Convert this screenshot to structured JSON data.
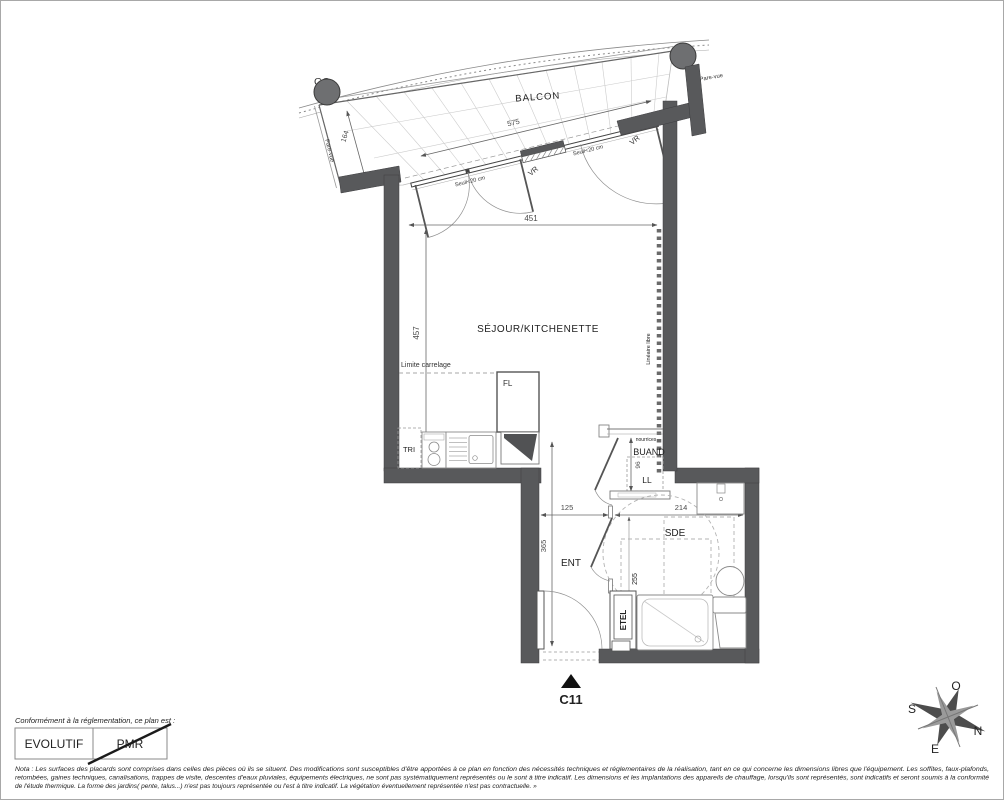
{
  "colors": {
    "wall": "#58595b",
    "accent_dark": "#111111",
    "line_light": "#bbbbbb",
    "background": "#ffffff"
  },
  "plan": {
    "unit_label": "C11",
    "rooms": {
      "balcony": "BALCON",
      "living": "SÉJOUR/KITCHENETTE",
      "laundry": "BUAND",
      "shower_room": "SDE",
      "entrance": "ENT"
    },
    "annotations": {
      "gc": "GC",
      "pare_vue_left": "Pare-vue",
      "pare_vue_right": "Pare-vue",
      "vr_left": "VR",
      "vr_right": "VR",
      "seuil_left": "Seuil<20 cm",
      "seuil_right": "Seuil<20 cm",
      "limite_carrelage": "Limite carrelage",
      "lineaire_libre": "Linéaire libre",
      "tri": "TRI",
      "fl": "FL",
      "ll": "LL",
      "nourrices": "nourrices",
      "etel": "ETEL"
    },
    "dimensions": {
      "balcony_width": "575",
      "balcony_depth": "164",
      "living_width": "451",
      "living_depth": "457",
      "entrance_width": "125",
      "shower_width": "214",
      "entrance_depth": "365",
      "shower_depth": "255",
      "laundry_depth": "96"
    }
  },
  "compass": {
    "north": "N",
    "south": "S",
    "east": "E",
    "west": "O"
  },
  "stamp": {
    "caption": "Conformément à la réglementation, ce plan est :",
    "evolutif": "EVOLUTIF",
    "pmr": "PMR"
  },
  "legal": {
    "line1": "Nota : Les surfaces des placards sont comprises dans celles des pièces où ils se situent. Des modifications sont susceptibles d'être apportées à ce plan en fonction des nécessités techniques et réglementaires de la réalisation, tant en ce qui concerne les dimensions libres que l'équipement.  Les soffites, faux-plafonds,",
    "line2": "retombées, gaines techniques, canalisations, trappes de visite, descentes d'eaux pluviales, équipements électriques, ne sont pas systématiquement représentés ou le sont à titre indicatif. Les dimensions et les implantations des appareils de chauffage, lorsqu'ils sont représentés, sont indicatifs et seront soumis à la conformité",
    "line3": "de l'étude thermique. La forme des jardins( pente, talus...) n'est pas toujours représentée ou l'est à titre indicatif. La végétation éventuellement représentée n'est pas contractuelle. »"
  }
}
